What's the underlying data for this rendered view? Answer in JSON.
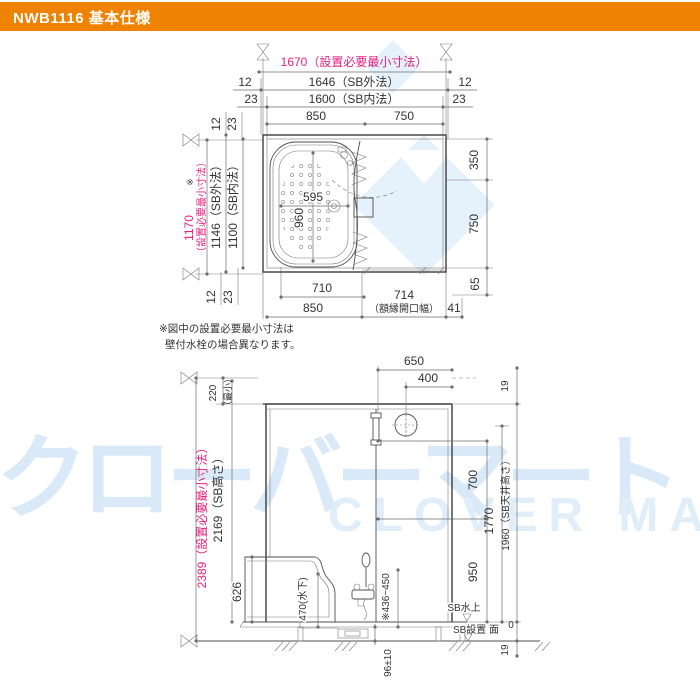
{
  "header": {
    "title": "NWB1116 基本仕様"
  },
  "watermark": {
    "jp": "クローバーマート",
    "en": "CLOVER MART"
  },
  "note": {
    "line1": "※図中の設置必要最小寸法は",
    "line2": "壁付水栓の場合異なります。"
  },
  "plan": {
    "top": {
      "total": "1670（設置必要最小寸法）",
      "outer_left": "12",
      "outer": "1646（SB外法）",
      "outer_right": "12",
      "inner_left": "23",
      "inner": "1600（SB内法）",
      "inner_right": "23",
      "bath": "850",
      "wash": "750"
    },
    "left": {
      "mark": "※",
      "total": "1170",
      "total_label": "（設置必要最小寸法）",
      "outer": "1146（SB外法）",
      "inner": "1100（SB内法）",
      "top_outer": "12",
      "top_inner": "23",
      "bottom_outer": "12",
      "bottom_inner": "23"
    },
    "right": {
      "upper": "350",
      "lower": "750",
      "below": "65"
    },
    "bottom": {
      "tub": "710",
      "bath": "850",
      "opening": "714",
      "opening_label": "（額縁開口幅）",
      "offset": "41"
    },
    "tub": {
      "width": "595",
      "length": "960"
    }
  },
  "elevation": {
    "top": {
      "bar": "650",
      "fan": "400",
      "edge": "19"
    },
    "left": {
      "min": "220",
      "min_label": "（最小）",
      "total": "2389（設置必要最小寸法）",
      "height": "2169（SB高さ）",
      "tub": "626",
      "drain": "470(水下)"
    },
    "right": {
      "upper": "700",
      "mid": "1770",
      "ceiling": "1960（SB天井高さ）",
      "lower": "950",
      "zero": "0",
      "base": "19"
    },
    "bottom": {
      "legs": "96±10",
      "faucet": "※436~450",
      "pan_top": "SB水上",
      "surface": "SB設置 面"
    }
  }
}
